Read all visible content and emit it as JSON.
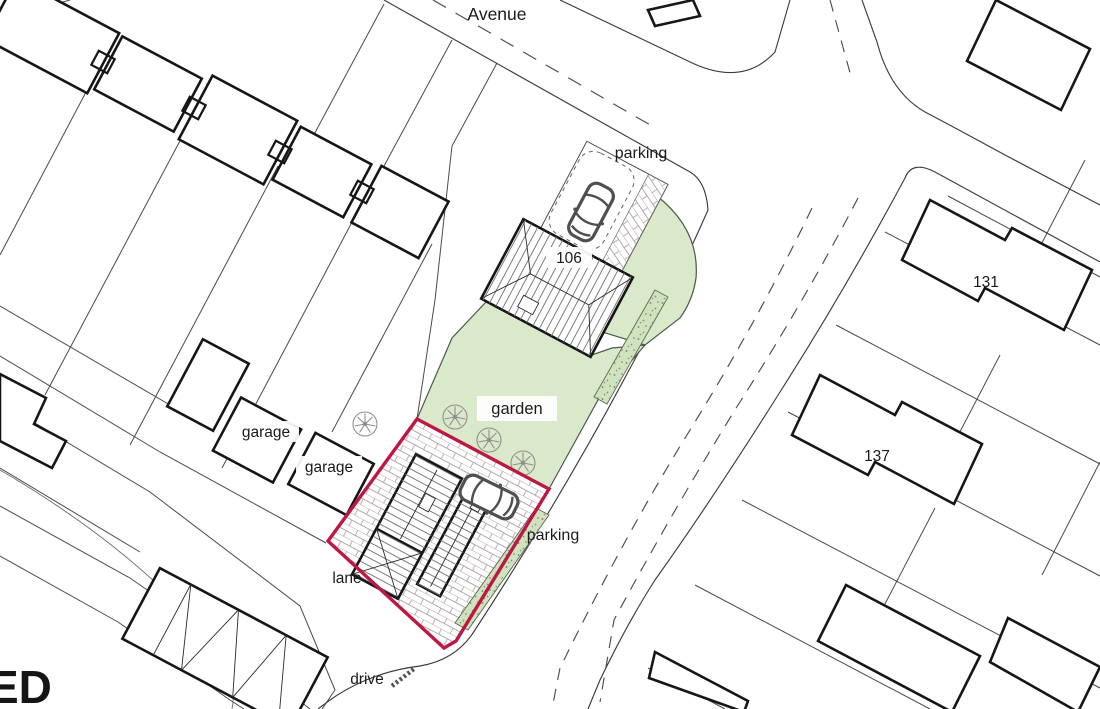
{
  "map": {
    "street_labels": {
      "avenue": "Avenue",
      "lane": "lane",
      "drive": "drive",
      "street_partial": "ED"
    },
    "area_labels": {
      "parking_top": "parking",
      "parking_side": "parking",
      "garden": "garden",
      "garage_upper": "garage",
      "garage_lower": "garage"
    },
    "house_numbers": {
      "plot_house": "106",
      "right_upper": "131",
      "right_lower": "137"
    },
    "colors": {
      "garden_green": "#dbe9cb",
      "hedge_green": "#cfe3bc",
      "boundary_red": "#bd1843",
      "building_line": "#161616",
      "parcel_line": "#4a4a4a",
      "brick_line": "#b3a9a9",
      "car_gray": "#4f4f4f",
      "tree_gray": "#8f8f8f"
    }
  }
}
